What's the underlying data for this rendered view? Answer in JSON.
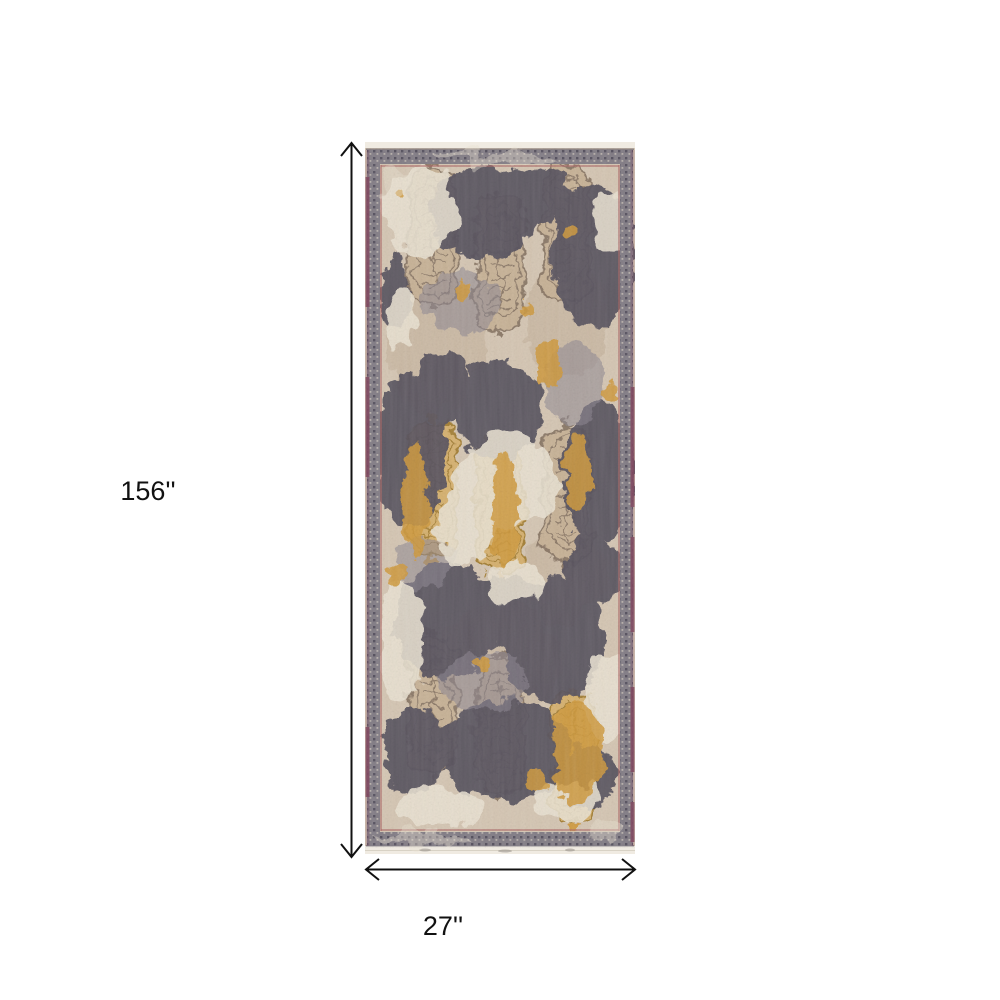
{
  "page": {
    "background_color": "#ffffff",
    "description": "Product dimension diagram of a distressed vintage runner rug"
  },
  "dimensions": {
    "height_label": "156''",
    "width_label": "27''"
  },
  "rug": {
    "alt": "Distressed oriental runner rug in gray, cream, gold and purple",
    "colors": {
      "fringe": "#f0ebe1",
      "base": "#d6c6b1",
      "base_shade": "#c3af97",
      "border_gray": "#837d87",
      "border_dot": "#565160",
      "field_dark": "#585360",
      "mid_gray": "#8e8793",
      "tan_fill": "#c9b294",
      "tan_line": "#8a7662",
      "gold": "#d49a36",
      "gold_fill": "#dab066",
      "gold_line": "#a57d2a",
      "maroon": "#82445e",
      "accent_red": "#b06565",
      "cream": "#ebe2d1",
      "arrow": "#111111"
    }
  }
}
